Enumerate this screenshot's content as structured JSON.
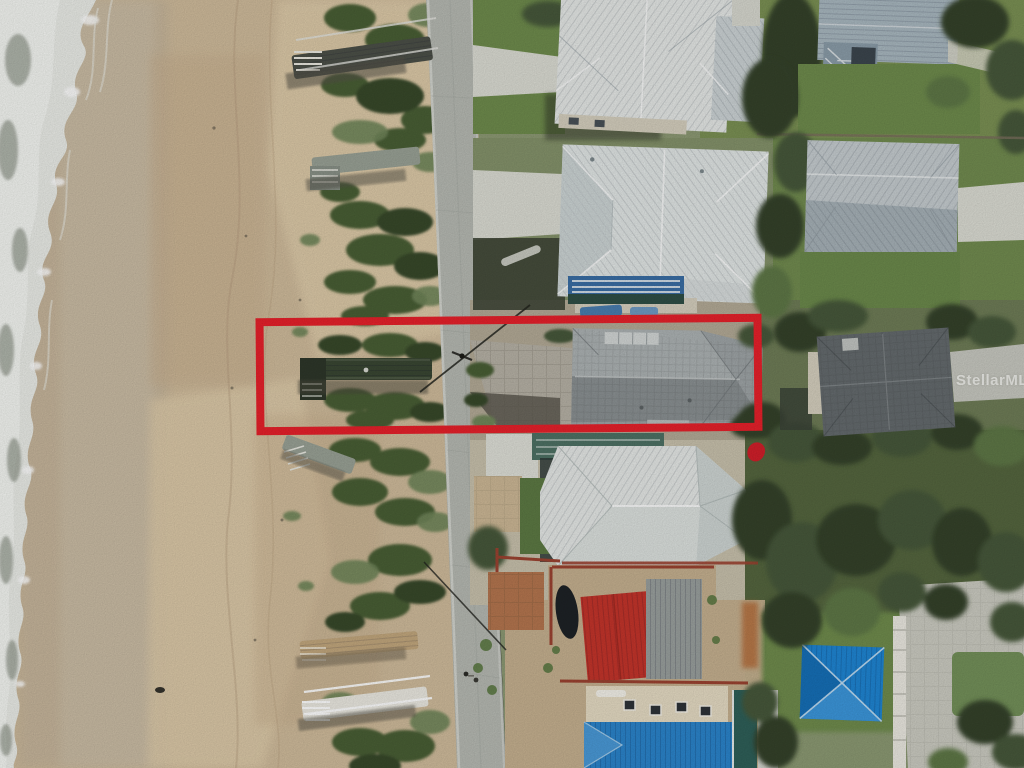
{
  "image": {
    "kind": "aerial-drone-photo",
    "description": "Top-down aerial photo of an oceanfront lot: surf and beach on the left, dune vegetation and boardwalks in the middle, a coastal road, and beach houses on the right. A thick red rectangle highlights the vacant oceanfront parcel with its private dune crossover.",
    "width": 1024,
    "height": 768
  },
  "watermark": {
    "text": "StellarMLS"
  },
  "annotation": {
    "type": "property-boundary-rectangle",
    "color": "#e8212b"
  },
  "colors": {
    "outlineRed": "#e8212b",
    "markerRed": "#d21f2a",
    "ocean": "#7e857a",
    "foam": "#eceee9",
    "foamBright": "#f6f7f4",
    "sand": "#d0bc9c",
    "sandWet": "#c6b69c",
    "sandLight": "#e0cdab",
    "sandDark": "#c9b190",
    "duneGreen": "#4a5e36",
    "duneGreenDark": "#394a2c",
    "duneGreenLight": "#71875a",
    "treeDark": "#34432a",
    "treeMid": "#46593a",
    "treeLight": "#5f7847",
    "lawn": "#6f8c4d",
    "eastBase": "#8d9a74",
    "road": "#b7bab3",
    "concrete": "#dcddd4",
    "paver": "#b7b2a6",
    "whiteRoof": "#e6e9e7",
    "whiteRoof2": "#e2e7e6",
    "silverRoof": "#c6cdd0",
    "blueGrayRoof": "#a9b8c0",
    "grayShingle": "#9fa5a7",
    "grayShingleLight": "#adb3b4",
    "grayShingleDark": "#8b9193",
    "darkShingle": "#656b6e",
    "redRoof": "#c5352b",
    "grayMetalSmall": "#9aa09e",
    "blueRoof": "#2b85cc",
    "blueHipRoof": "#1f86d4",
    "tealPool": "#2f6059",
    "poolEnclosure": "#4e7265",
    "creamDeck": "#e6dcc4",
    "creamWall": "#d6d0bf",
    "fenceRust": "#9c4331",
    "brick": "#b5764f",
    "dirtYard": "#c6b190",
    "walkwayWood": "#c3a87e",
    "walkwayWhite": "#eceae2",
    "walkwayGreen": "#3a4733",
    "walkwayGray": "#9aa296",
    "shadow": "#2e3328",
    "powerline": "#23241f"
  }
}
